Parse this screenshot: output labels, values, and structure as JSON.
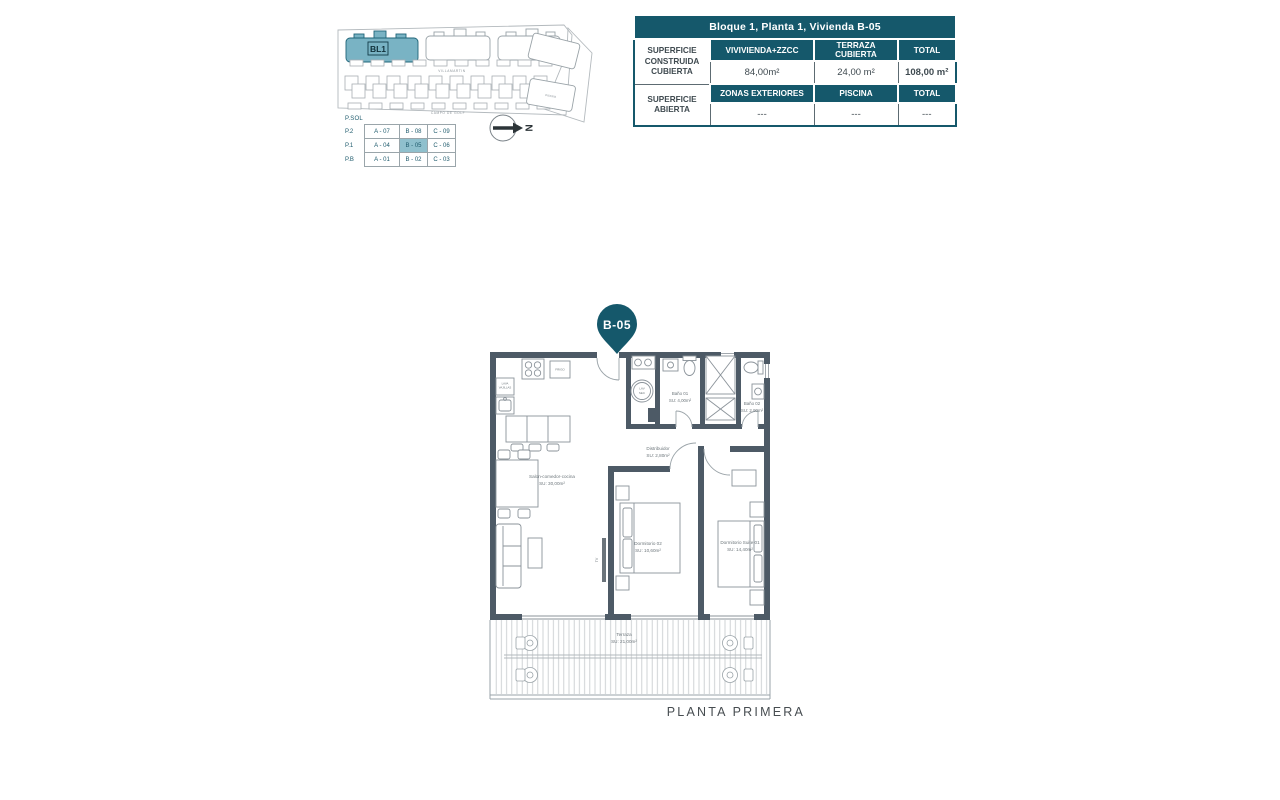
{
  "page": {
    "caption": "PLANTA PRIMERA"
  },
  "site_plan": {
    "bl1_label": "BL1",
    "street_top": "VILLAMARTIN",
    "street_bottom": "CAMPO DE GOLF",
    "building_right_label": "PISCINA"
  },
  "north_arrow": {
    "label": "N"
  },
  "levels_table": {
    "corner_label": "P.SOL",
    "rows": [
      {
        "level": "P.2",
        "units": [
          "A - 07",
          "B - 08",
          "C - 09"
        ]
      },
      {
        "level": "P.1",
        "units": [
          "A - 04",
          "B - 05",
          "C - 06"
        ]
      },
      {
        "level": "P.B",
        "units": [
          "A - 01",
          "B - 02",
          "C - 03"
        ]
      }
    ],
    "highlighted_unit": "B - 05"
  },
  "summary_table": {
    "title": "Bloque 1, Planta 1, Vivienda B-05",
    "sections": [
      {
        "label": "SUPERFICIE CONSTRUIDA CUBIERTA",
        "columns": [
          "VIVIVIENDA+ZZCC",
          "TERRAZA CUBIERTA",
          "TOTAL"
        ],
        "values": [
          "84,00m²",
          "24,00 m²",
          "108,00 m²"
        ]
      },
      {
        "label": "SUPERFICIE ABIERTA",
        "columns": [
          "ZONAS EXTERIORES",
          "PISCINA",
          "TOTAL"
        ],
        "values": [
          "---",
          "---",
          "---"
        ]
      }
    ]
  },
  "floor_plan": {
    "pin": "B-05",
    "rooms": {
      "salon": {
        "name": "Salon-comedor-cocina",
        "area": "SU: 30,00m²"
      },
      "distribuidor": {
        "name": "Distribuidor",
        "area": "SU: 2,80m²"
      },
      "bano1": {
        "name": "Baño 01",
        "area": "SU: 4,00m²"
      },
      "bano2": {
        "name": "Baño 02",
        "area": "SU: 2,90m²"
      },
      "dorm2": {
        "name": "Dormitorio 02",
        "area": "SU: 10,60m²"
      },
      "suite": {
        "name": "Dormitorio Suite 01",
        "area": "SU: 14,40m²"
      },
      "terraza": {
        "name": "Terraza",
        "area": "SU: 21,00m²"
      }
    },
    "annotations": {
      "frigo": "FRIGO",
      "lavavajillas_line1": "LAVA",
      "lavavajillas_line2": "VAJILLAS",
      "washer_line1": "LAV",
      "washer_line2": "SEC",
      "tv": "TV"
    }
  },
  "colors": {
    "teal_dark": "#15586b",
    "teal_light": "#8fc0cd",
    "wall": "#4d5a66",
    "building_teal": "#79b3c4"
  }
}
